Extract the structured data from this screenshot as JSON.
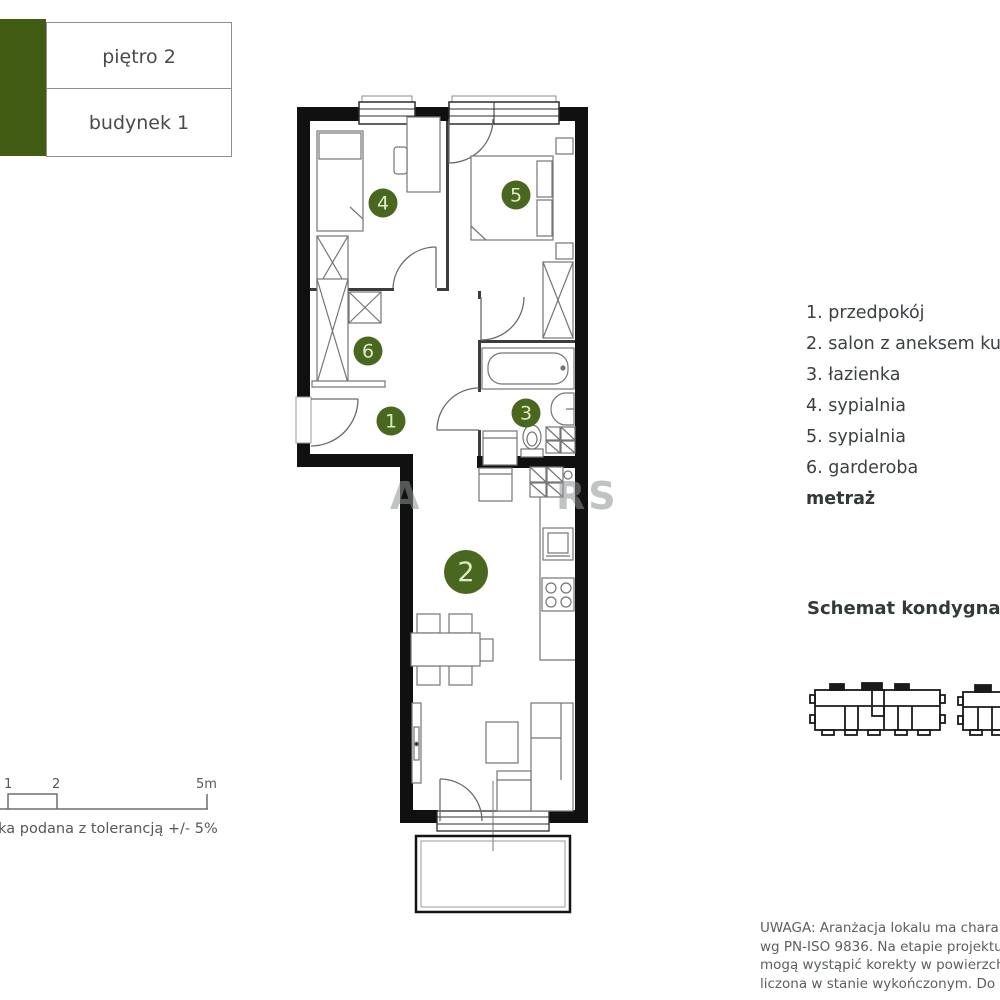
{
  "header": {
    "floor": "piętro 2",
    "building": "budynek 1"
  },
  "plan": {
    "rooms": [
      {
        "label": "1"
      },
      {
        "label": "2"
      },
      {
        "label": "3"
      },
      {
        "label": "4"
      },
      {
        "label": "5"
      },
      {
        "label": "6"
      }
    ]
  },
  "legend": {
    "items": [
      "1. przedpokój",
      "2. salon z aneksem kuch",
      "3. łazienka",
      "4. sypialnia",
      "5. sypialnia",
      "6. garderoba"
    ],
    "metraz": "metraż"
  },
  "schematic": {
    "title": "Schemat kondygnacji"
  },
  "scale": {
    "t1": "1",
    "t2": "2",
    "t3": "5m",
    "note": "łka podana z tolerancją +/- 5%"
  },
  "disclaimer": [
    "UWAGA: Aranżacja lokalu ma charakter p",
    "wg PN-ISO 9836. Na etapie projektu wyko",
    "mogą wystąpić korekty w powierzchni lok",
    "liczona w stanie wykończonym. Do oblicze"
  ],
  "watermark": {
    "left": "A",
    "right": "RS"
  },
  "colors": {
    "accent_green": "#425d13",
    "badge_green": "#4a671f",
    "wall": "#101010"
  }
}
